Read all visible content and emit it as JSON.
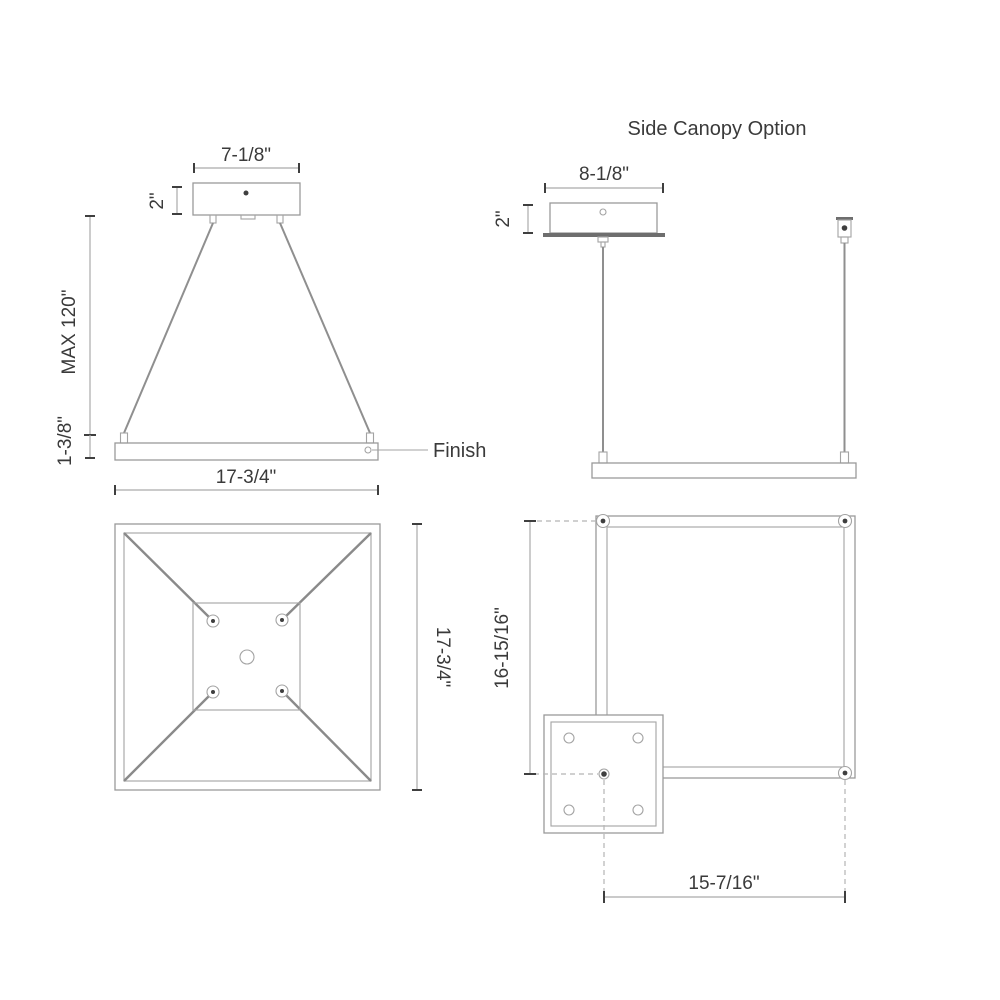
{
  "front_view": {
    "canopy_width": "7-1/8\"",
    "canopy_height": "2\"",
    "max_suspension": "MAX 120\"",
    "fixture_height": "1-3/8\"",
    "fixture_width": "17-3/4\"",
    "finish_label": "Finish"
  },
  "side_canopy_view": {
    "title": "Side Canopy Option",
    "canopy_width": "8-1/8\"",
    "canopy_height": "2\""
  },
  "plan_view": {
    "fixture_depth": "17-3/4\""
  },
  "side_canopy_plan_view": {
    "vertical_offset": "16-15/16\"",
    "horizontal_offset": "15-7/16\""
  },
  "colors": {
    "line": "#9a9a9a",
    "dark": "#3f3f3f",
    "text": "#3a3a3a",
    "background": "#ffffff"
  }
}
